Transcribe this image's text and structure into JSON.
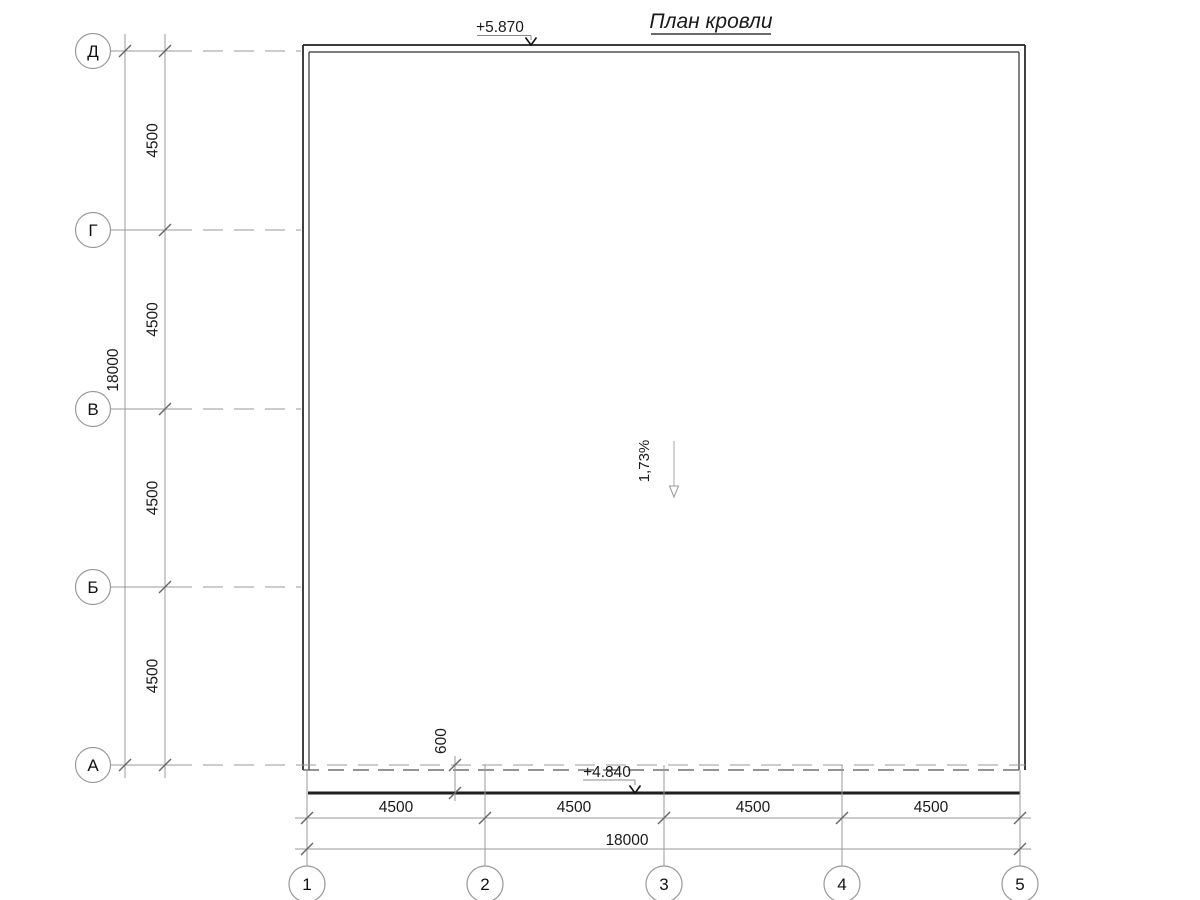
{
  "title": "План кровли",
  "elevations": {
    "top": "+5.870",
    "bottom": "+4.840"
  },
  "slope": {
    "label": "1,73%"
  },
  "dimensions": {
    "left": {
      "total": "18000",
      "segments": [
        "4500",
        "4500",
        "4500",
        "4500"
      ]
    },
    "bottom": {
      "total": "18000",
      "segments": [
        "4500",
        "4500",
        "4500",
        "4500"
      ]
    },
    "overhang": "600"
  },
  "axes": {
    "left": {
      "labels": [
        "Д",
        "Г",
        "В",
        "Б",
        "А"
      ]
    },
    "bottom": {
      "labels": [
        "1",
        "2",
        "3",
        "4",
        "5"
      ]
    }
  },
  "colors": {
    "wall_line": "#1f1f1f",
    "inner_line": "#2e2e2e",
    "dim_line": "#9a9a9a",
    "hidden_line": "#555555",
    "text": "#1a1a1a"
  }
}
